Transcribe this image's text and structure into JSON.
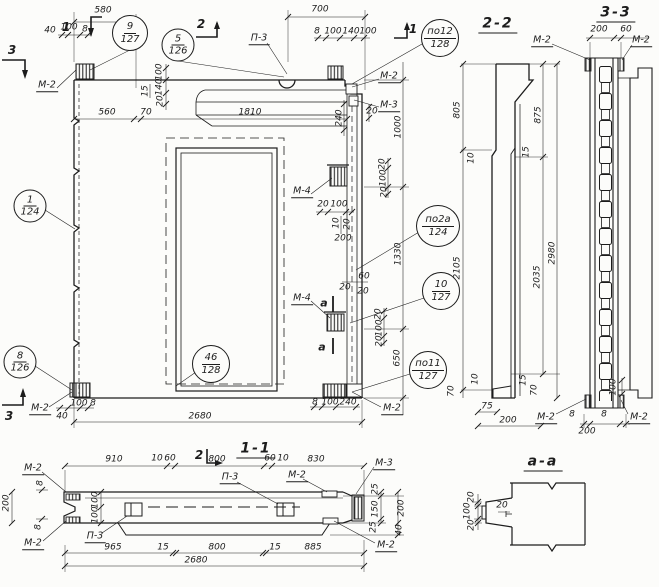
{
  "views": {
    "elevation": {
      "markers": {
        "m1_topleft": "1",
        "m2_top": "2",
        "m1_topright": "1",
        "m3_topleft": "3",
        "m3_bottomleft": "3",
        "cut_a_upper": "a",
        "cut_a_lower": "a"
      },
      "callouts": [
        {
          "num": "9",
          "den": "127"
        },
        {
          "num": "5",
          "den": "126"
        },
        {
          "num": "по12",
          "den": "128"
        },
        {
          "num": "1",
          "den": "124"
        },
        {
          "num": "по2а",
          "den": "124"
        },
        {
          "num": "10",
          "den": "127"
        },
        {
          "num": "8",
          "den": "126"
        },
        {
          "num": "46",
          "den": "128"
        },
        {
          "num": "по11",
          "den": "127"
        }
      ],
      "marks": [
        "М-2",
        "П-3",
        "М-2",
        "М-3",
        "М-4",
        "М-4",
        "М-2",
        "М-2"
      ],
      "dims_top": [
        "580",
        "700"
      ],
      "dims_top_left_small": [
        "40",
        "100",
        "8"
      ],
      "dims_top_right_small": [
        "8",
        "100",
        "140",
        "100"
      ],
      "dims_band": [
        "560",
        "70",
        "1810"
      ],
      "dims_band_stack": [
        "100",
        "140",
        "20",
        "15"
      ],
      "dims_right_corner": [
        "240",
        "20"
      ],
      "dims_right_stack_upper": [
        "20",
        "100",
        "20"
      ],
      "dims_right_vertical": [
        "1000",
        "1330",
        "650"
      ],
      "dims_mid_anchor": [
        "20",
        "100",
        "10",
        "20",
        "200"
      ],
      "dims_a_cut": [
        "60",
        "20",
        "20"
      ],
      "dims_right_stack_lower": [
        "20",
        "100",
        "20"
      ],
      "dims_bottom_left_small": [
        "40",
        "100",
        "8"
      ],
      "dims_bottom_right_small": [
        "8",
        "100",
        "240"
      ],
      "dim_overall_width": "2680"
    },
    "section_2_2": {
      "title": "2-2",
      "dims_left": [
        "805",
        "2105"
      ],
      "dims_right": [
        "875",
        "2035"
      ],
      "dim_overall_height": "2980",
      "dims_steps": [
        "10",
        "15"
      ],
      "dims_bottom": [
        "70",
        "10",
        "75",
        "200",
        "15",
        "70"
      ]
    },
    "section_3_3": {
      "title": "3-3",
      "dims_top": [
        "200",
        "60"
      ],
      "marks_top": [
        "М-2",
        "М-2"
      ],
      "dims_bottom": [
        "8",
        "200",
        "8",
        "100"
      ],
      "marks_bottom": [
        "М-2",
        "М-2"
      ]
    },
    "plan_1_1": {
      "title": "1-1",
      "marker": "2",
      "dims_top": [
        "910",
        "10",
        "60",
        "800",
        "60",
        "10",
        "830"
      ],
      "dims_bottom": [
        "965",
        "15",
        "800",
        "15",
        "885"
      ],
      "dim_overall": "2680",
      "dims_left": [
        "200",
        "8",
        "8",
        "100",
        "100"
      ],
      "dims_right": [
        "25",
        "150",
        "200",
        "25",
        "40"
      ],
      "marks": [
        "М-2",
        "М-2",
        "П-3",
        "П-3",
        "М-2",
        "М-3",
        "М-2"
      ]
    },
    "detail_a_a": {
      "title": "а-а",
      "dims": [
        "20",
        "100",
        "20",
        "20"
      ]
    }
  }
}
